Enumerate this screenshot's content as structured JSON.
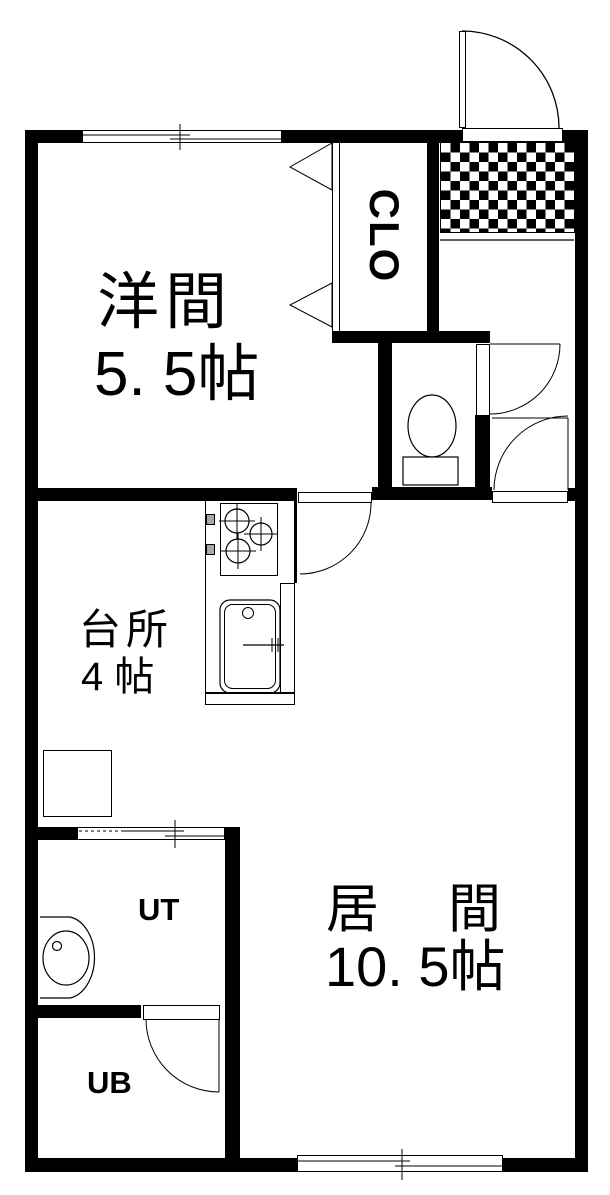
{
  "rooms": {
    "yokan": {
      "label": "洋間",
      "size": "5. 5帖"
    },
    "kitchen": {
      "label": "台所",
      "size": "4 帖"
    },
    "living": {
      "label": "居　間",
      "size": "10. 5帖"
    },
    "utility": {
      "label": "UT"
    },
    "bath": {
      "label": "UB"
    },
    "closet": {
      "label": "CLO"
    }
  },
  "colors": {
    "wall": "#000000",
    "background": "#ffffff",
    "line": "#000000",
    "knob_gray": "#a8a8a8"
  }
}
